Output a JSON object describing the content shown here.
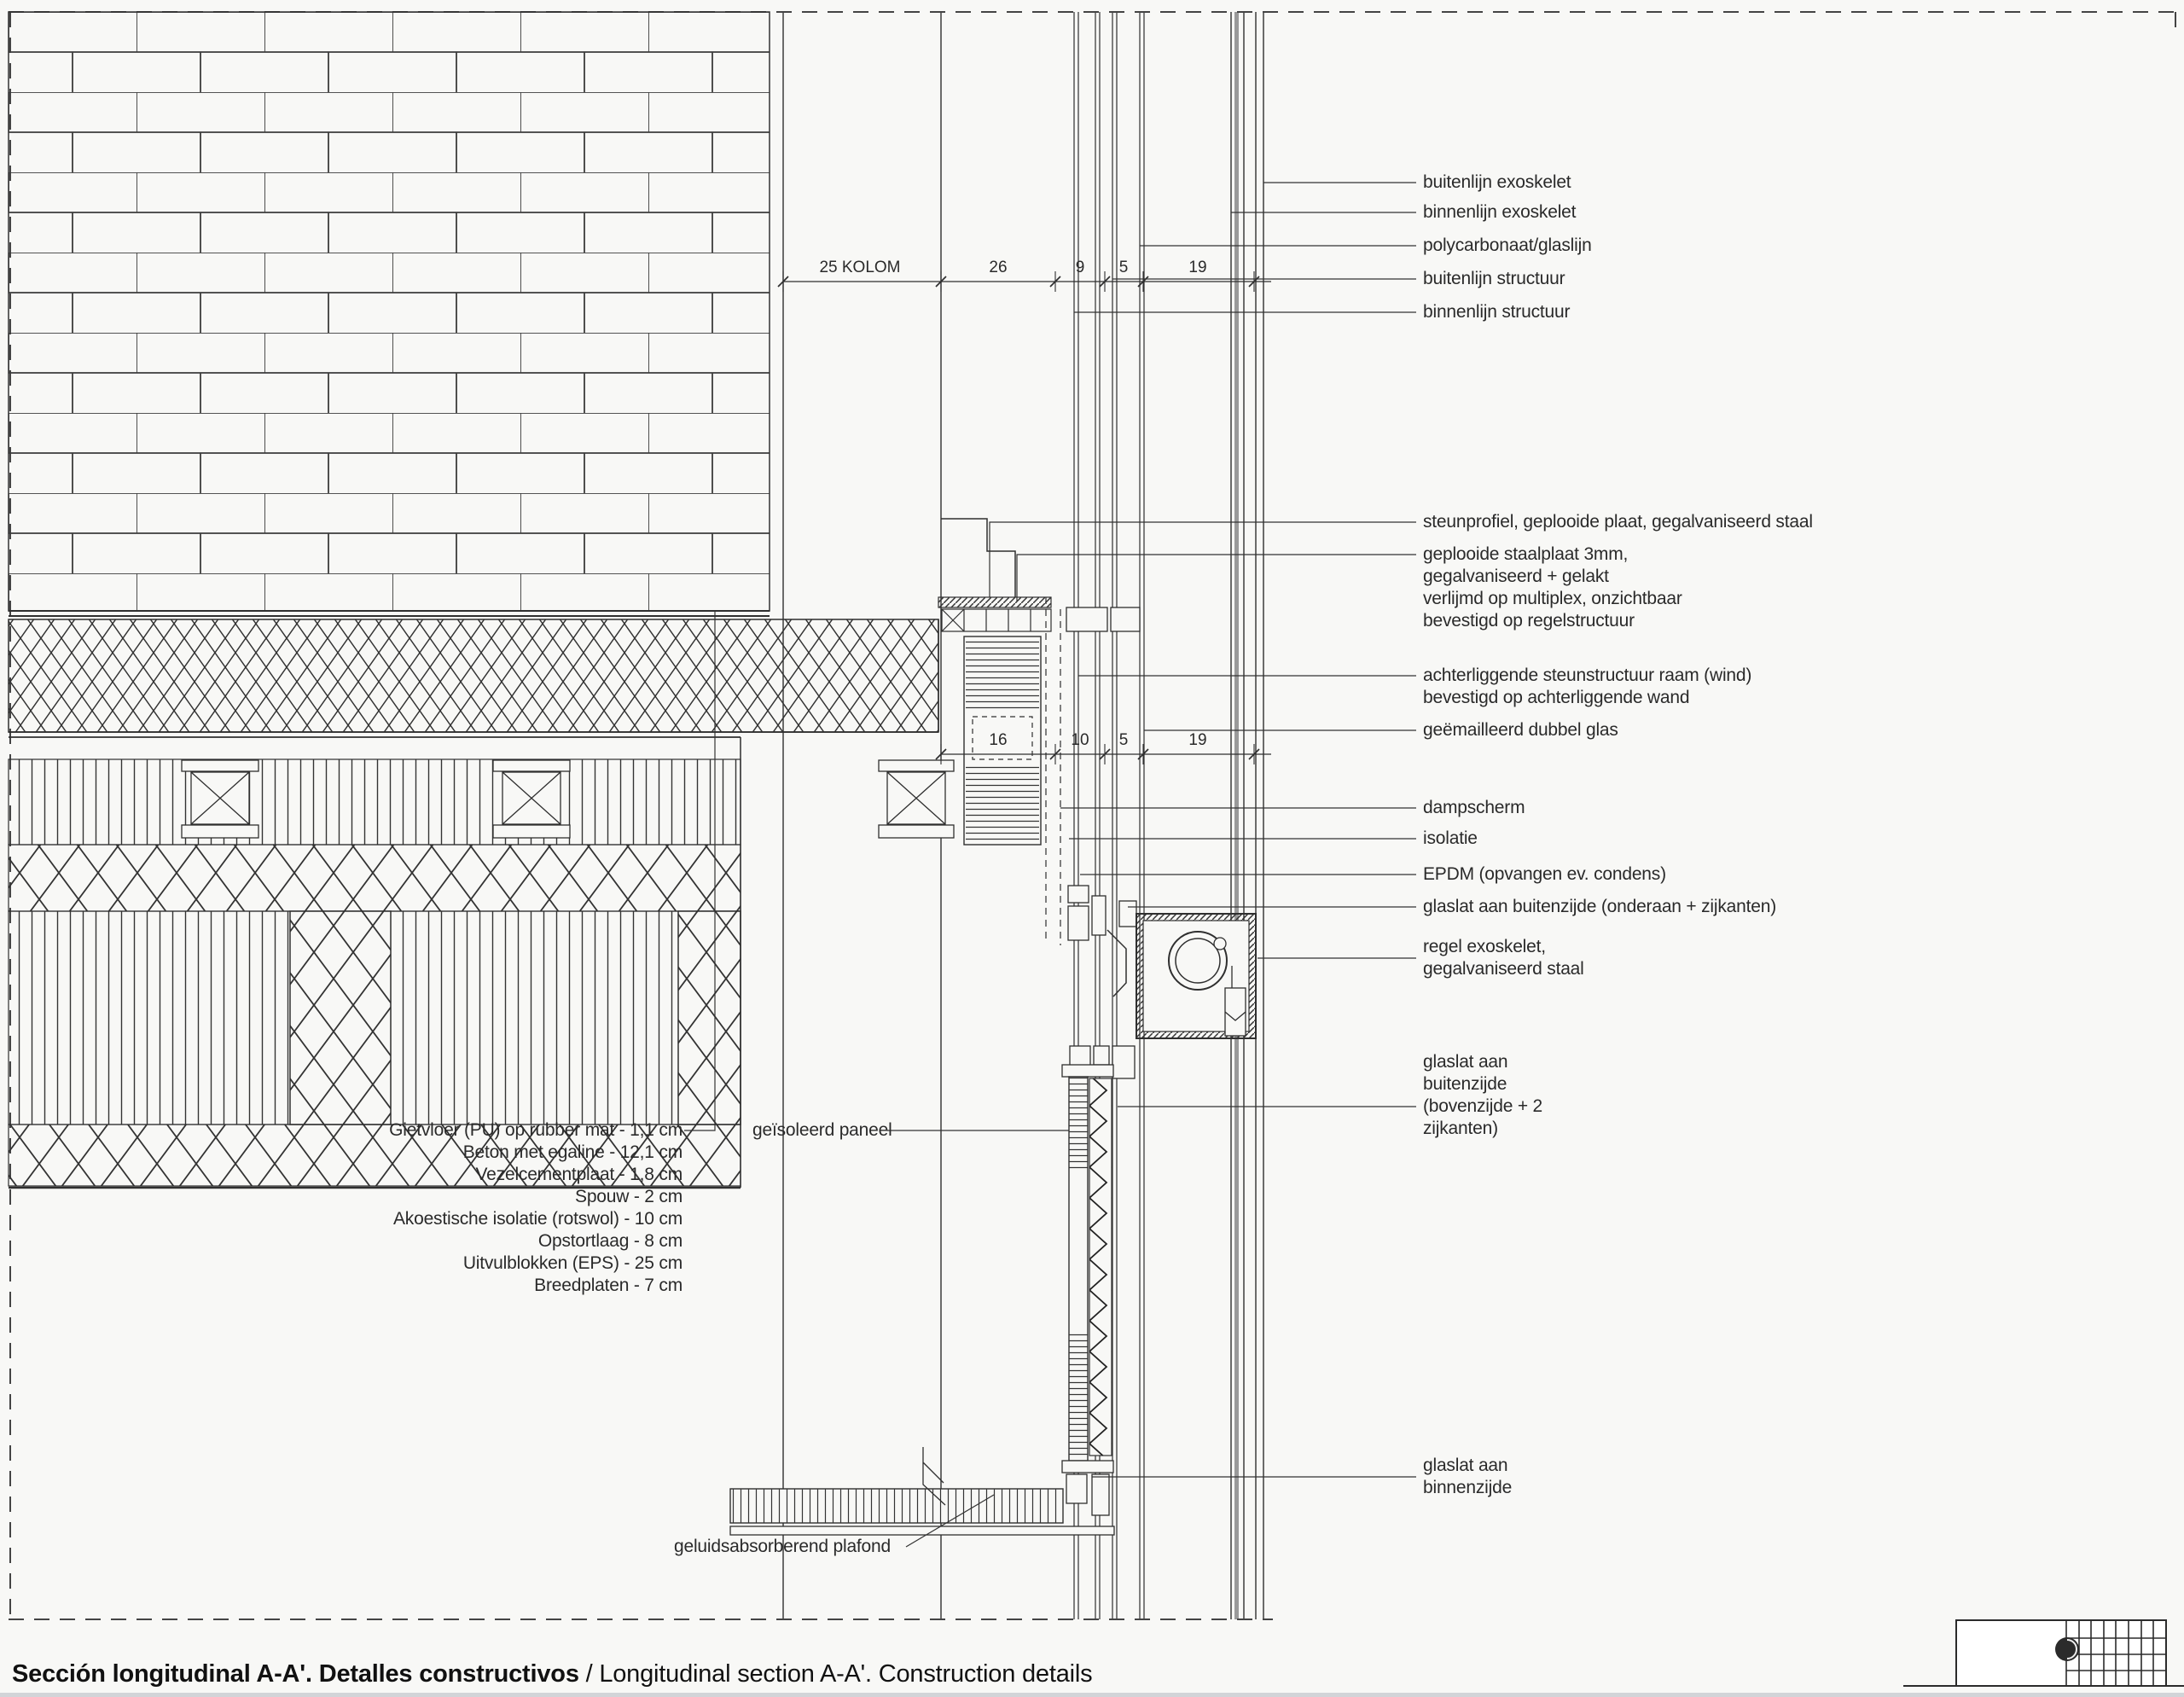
{
  "title": {
    "primary": "Sección longitudinal A-A'. Detalles constructivos",
    "separator": " / ",
    "secondary": "Longitudinal section A-A'. Construction details"
  },
  "dim_top": {
    "d1": "25 KOLOM",
    "d2": "26",
    "d3": "9",
    "d4": "5",
    "d5": "19"
  },
  "dim_mid": {
    "d1": "16",
    "d2": "10",
    "d3": "5",
    "d4": "19"
  },
  "right_labels": {
    "buitenlijn_exoskelet": "buitenlijn exoskelet",
    "binnenlijn_exoskelet": "binnenlijn exoskelet",
    "polycarbonaat": "polycarbonaat/glaslijn",
    "buitenlijn_structuur": "buitenlijn structuur",
    "binnenlijn_structuur": "binnenlijn structuur",
    "steunprofiel": "steunprofiel, geplooide plaat, gegalvaniseerd staal",
    "geplooide_1": "geplooide staalplaat 3mm,",
    "geplooide_2": "gegalvaniseerd + gelakt",
    "geplooide_3": "verlijmd op multiplex, onzichtbaar",
    "geplooide_4": "bevestigd op regelstructuur",
    "achterliggende_1": "achterliggende steunstructuur raam (wind)",
    "achterliggende_2": "bevestigd op achterliggende wand",
    "dubbel_glas": "geëmailleerd dubbel glas",
    "dampscherm": "dampscherm",
    "isolatie": "isolatie",
    "epdm": "EPDM (opvangen ev. condens)",
    "glaslat_onder": "glaslat aan buitenzijde (onderaan + zijkanten)",
    "regel_1": "regel exoskelet,",
    "regel_2": "gegalvaniseerd staal",
    "glaslat_boven_1": "glaslat aan",
    "glaslat_boven_2": "buitenzijde",
    "glaslat_boven_3": "(bovenzijde + 2",
    "glaslat_boven_4": "zijkanten)",
    "glaslat_binnen_1": "glaslat aan",
    "glaslat_binnen_2": "binnenzijde"
  },
  "floor_layers": [
    "Gietvloer (PU) op rubber mat - 1,1 cm",
    "Beton met egaline - 12,1 cm",
    "Vezelcementplaat - 1,8 cm",
    "Spouw - 2 cm",
    "Akoestische isolatie (rotswol) - 10 cm",
    "Opstortlaag - 8 cm",
    "Uitvulblokken (EPS) - 25 cm",
    "Breedplaten - 7 cm"
  ],
  "left_labels": {
    "geisoleerd_paneel": "geïsoleerd paneel",
    "plafond": "geluidsabsorberend plafond"
  },
  "colors": {
    "line": "#2f2f2f",
    "paper": "#f8f8f6",
    "exo_grey": "#9a9a9a",
    "footer_rule": "#d2d4d8"
  }
}
